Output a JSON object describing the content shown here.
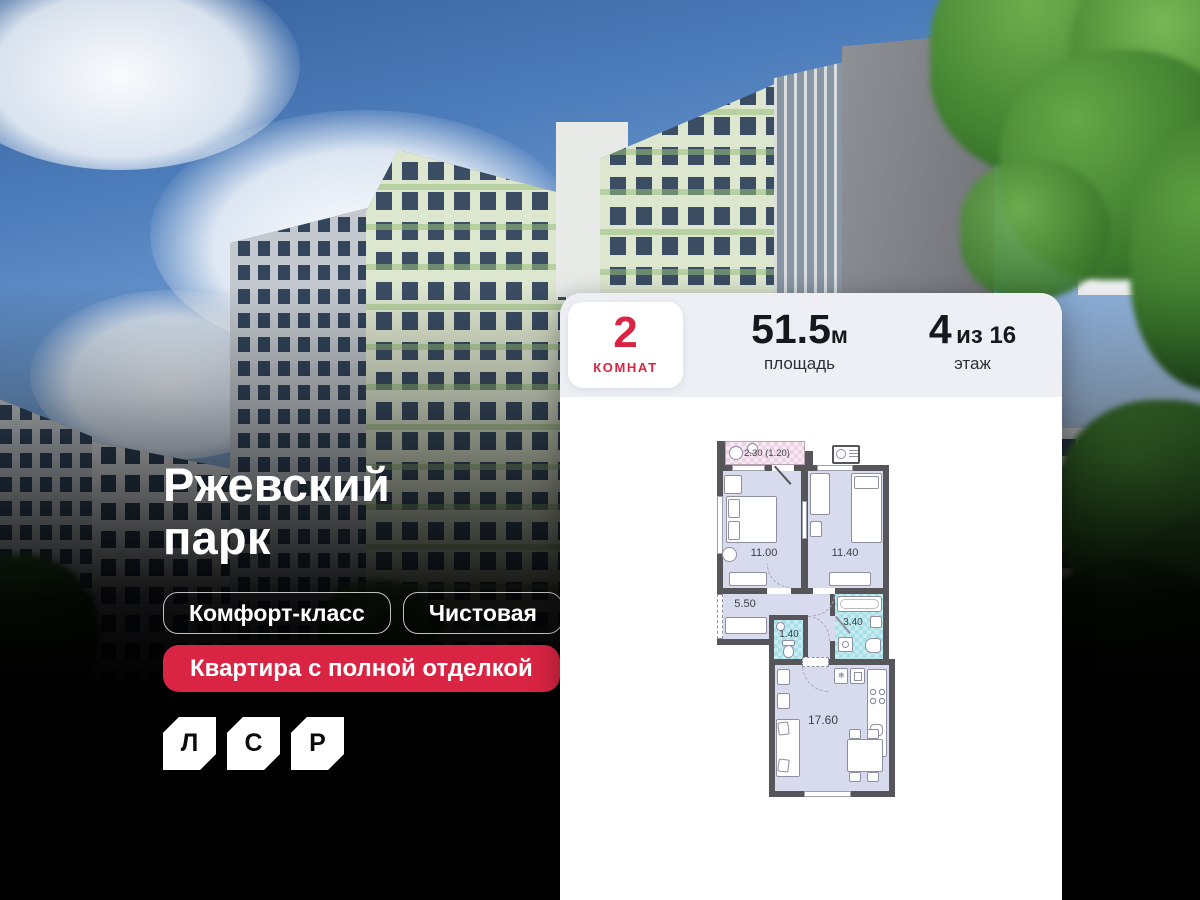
{
  "colors": {
    "accent_red": "#da2443",
    "card_header_bg": "#edeff4",
    "plan_room_fill": "#d8daee",
    "plan_wet_fill": "#a9dfe7",
    "plan_balcony_fill": "#ecd2e5",
    "plan_wall": "#56565a",
    "background": "#000000"
  },
  "hero": {
    "title": "Ржевский парк",
    "badges": [
      {
        "label": "Комфорт-класс"
      },
      {
        "label": "Чистовая"
      }
    ],
    "highlight_badge": "Квартира с полной отделкой",
    "logo_letters": [
      {
        "letter": "Л"
      },
      {
        "letter": "С"
      },
      {
        "letter": "Р"
      }
    ]
  },
  "card": {
    "rooms": {
      "value": "2",
      "label": "КОМНАТ"
    },
    "area": {
      "value": "51.5",
      "unit": "м",
      "label": "площадь"
    },
    "floor": {
      "value": "4",
      "of": "из 16",
      "label": "этаж"
    }
  },
  "floor_plan": {
    "balcony": {
      "area_label": "2.30 (1.20)"
    },
    "rooms": [
      {
        "name": "bedroom-1",
        "area": "11.00"
      },
      {
        "name": "bedroom-2",
        "area": "11.40"
      },
      {
        "name": "hallway",
        "area": "5.50"
      },
      {
        "name": "wc",
        "area": "1.40"
      },
      {
        "name": "bathroom",
        "area": "3.40"
      },
      {
        "name": "kitchen-living",
        "area": "17.60"
      }
    ]
  }
}
